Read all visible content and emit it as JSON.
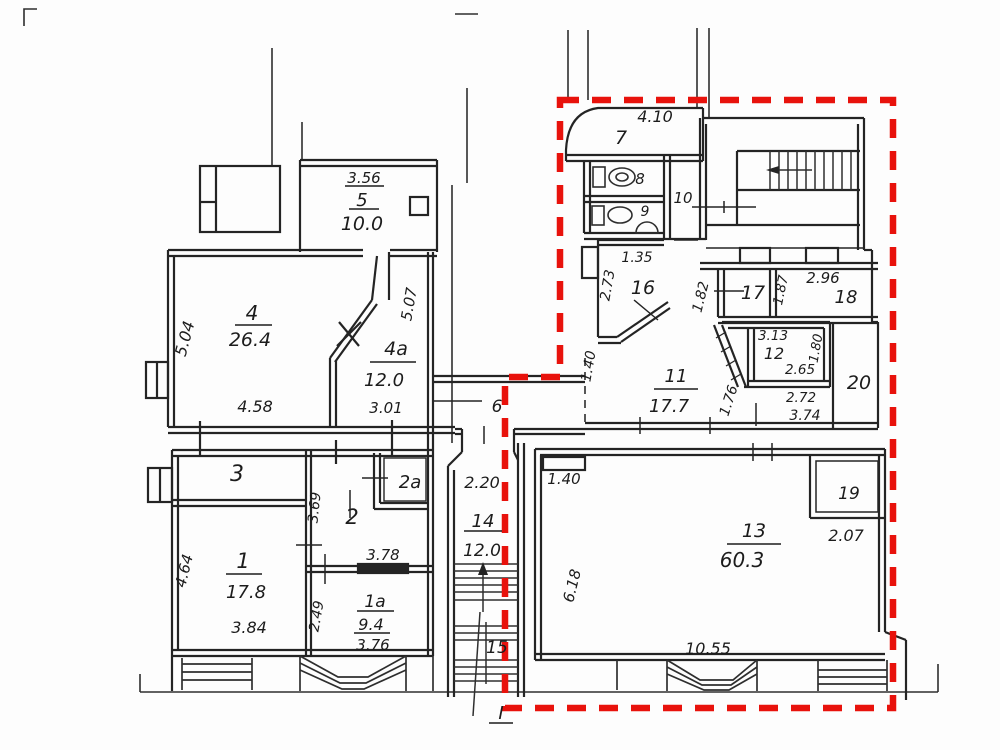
{
  "drawing": {
    "entrance_label": "I",
    "colors": {
      "line": "#242424",
      "highlight_red": "#e8120c"
    }
  },
  "rooms": {
    "r1": {
      "num": "1",
      "area": "17.8",
      "width": "3.84",
      "height": "4.64"
    },
    "r1a": {
      "num": "1a",
      "area": "9.4",
      "width": "3.76",
      "width_top": "3.78",
      "height": "2.49"
    },
    "r2": {
      "num": "2",
      "height": "3.69"
    },
    "r2a": {
      "num": "2a"
    },
    "r3": {
      "num": "3"
    },
    "r4": {
      "num": "4",
      "area": "26.4",
      "width": "4.58",
      "height": "5.04"
    },
    "r4a": {
      "num": "4a",
      "area": "12.0",
      "width": "3.01",
      "height": "5.07"
    },
    "r5": {
      "num": "5",
      "area": "10.0",
      "width": "3.56"
    },
    "r6": {
      "num": "6"
    },
    "r7": {
      "num": "7",
      "width": "4.10"
    },
    "r8": {
      "num": "8"
    },
    "r9": {
      "num": "9"
    },
    "r10": {
      "num": "10"
    },
    "r11": {
      "num": "11",
      "area": "17.7",
      "height": "1.40",
      "diag": "1.76"
    },
    "r12": {
      "num": "12",
      "width_top": "3.13",
      "width_inner": "2.65",
      "height": "1.80",
      "width_below": "2.72",
      "width_below2": "3.74"
    },
    "r13": {
      "num": "13",
      "area": "60.3",
      "width": "10.55",
      "height": "6.18",
      "niche": "1.40"
    },
    "r14": {
      "num": "14",
      "area": "12.0",
      "width": "2.20"
    },
    "r15": {
      "num": "15"
    },
    "r16": {
      "num": "16",
      "width": "1.35",
      "height": "2.73",
      "side": "1.82"
    },
    "r17": {
      "num": "17",
      "side": "1.87"
    },
    "r18": {
      "num": "18",
      "width": "2.96"
    },
    "r19": {
      "num": "19",
      "width": "2.07"
    },
    "r20": {
      "num": "20"
    }
  }
}
